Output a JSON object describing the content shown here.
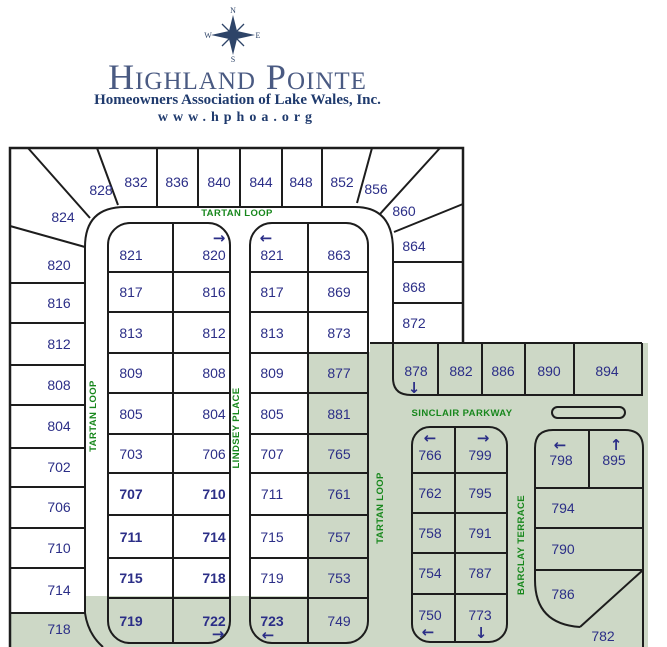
{
  "header": {
    "association": "Highland Pointe",
    "subtitle": "Homeowners Association of Lake Wales, Inc.",
    "website": "www.hphoa.org",
    "compass": {
      "n": "N",
      "e": "E",
      "s": "S",
      "w": "W"
    }
  },
  "colors": {
    "lot_green": "#cdd8c6",
    "number_navy": "#2b2e87",
    "street_green": "#17871c",
    "title_blue": "#4a5a82",
    "subtitle_navy": "#1f3a6d"
  },
  "streets": {
    "tartan_loop": "TARTAN LOOP",
    "lindsey_place": "LINDSEY PLACE",
    "sinclair_parkway": "SINCLAIR PARKWAY",
    "barclay_terrace": "BARCLAY TERRACE"
  },
  "arrows": {
    "left": "←",
    "right": "→",
    "up": "↑",
    "down": "↓"
  },
  "lots": {
    "nw": [
      "828",
      "824"
    ],
    "top_row": [
      "832",
      "836",
      "840",
      "844",
      "848",
      "852",
      "856"
    ],
    "ne": [
      "860",
      "864",
      "868",
      "872"
    ],
    "west_col": [
      "820",
      "816",
      "812",
      "808",
      "804",
      "702",
      "706",
      "710",
      "714",
      "718"
    ],
    "block_a_left": [
      "821",
      "817",
      "813",
      "809",
      "805",
      "703",
      "707",
      "711",
      "715",
      "719"
    ],
    "block_a_right": [
      "820",
      "816",
      "812",
      "808",
      "804",
      "706",
      "710",
      "714",
      "718",
      "722"
    ],
    "block_b_left": [
      "821",
      "817",
      "813",
      "809",
      "805",
      "707",
      "711",
      "715",
      "719",
      "723"
    ],
    "block_b_right": [
      "863",
      "869",
      "873",
      "877",
      "881",
      "765",
      "761",
      "757",
      "753",
      "749"
    ],
    "sinclair_row": [
      "878",
      "882",
      "886",
      "890",
      "894"
    ],
    "block_c_left": [
      "766",
      "762",
      "758",
      "754",
      "750"
    ],
    "block_c_right": [
      "799",
      "795",
      "791",
      "787",
      "773"
    ],
    "block_d": [
      "798",
      "895",
      "794",
      "790",
      "786",
      "782"
    ]
  }
}
